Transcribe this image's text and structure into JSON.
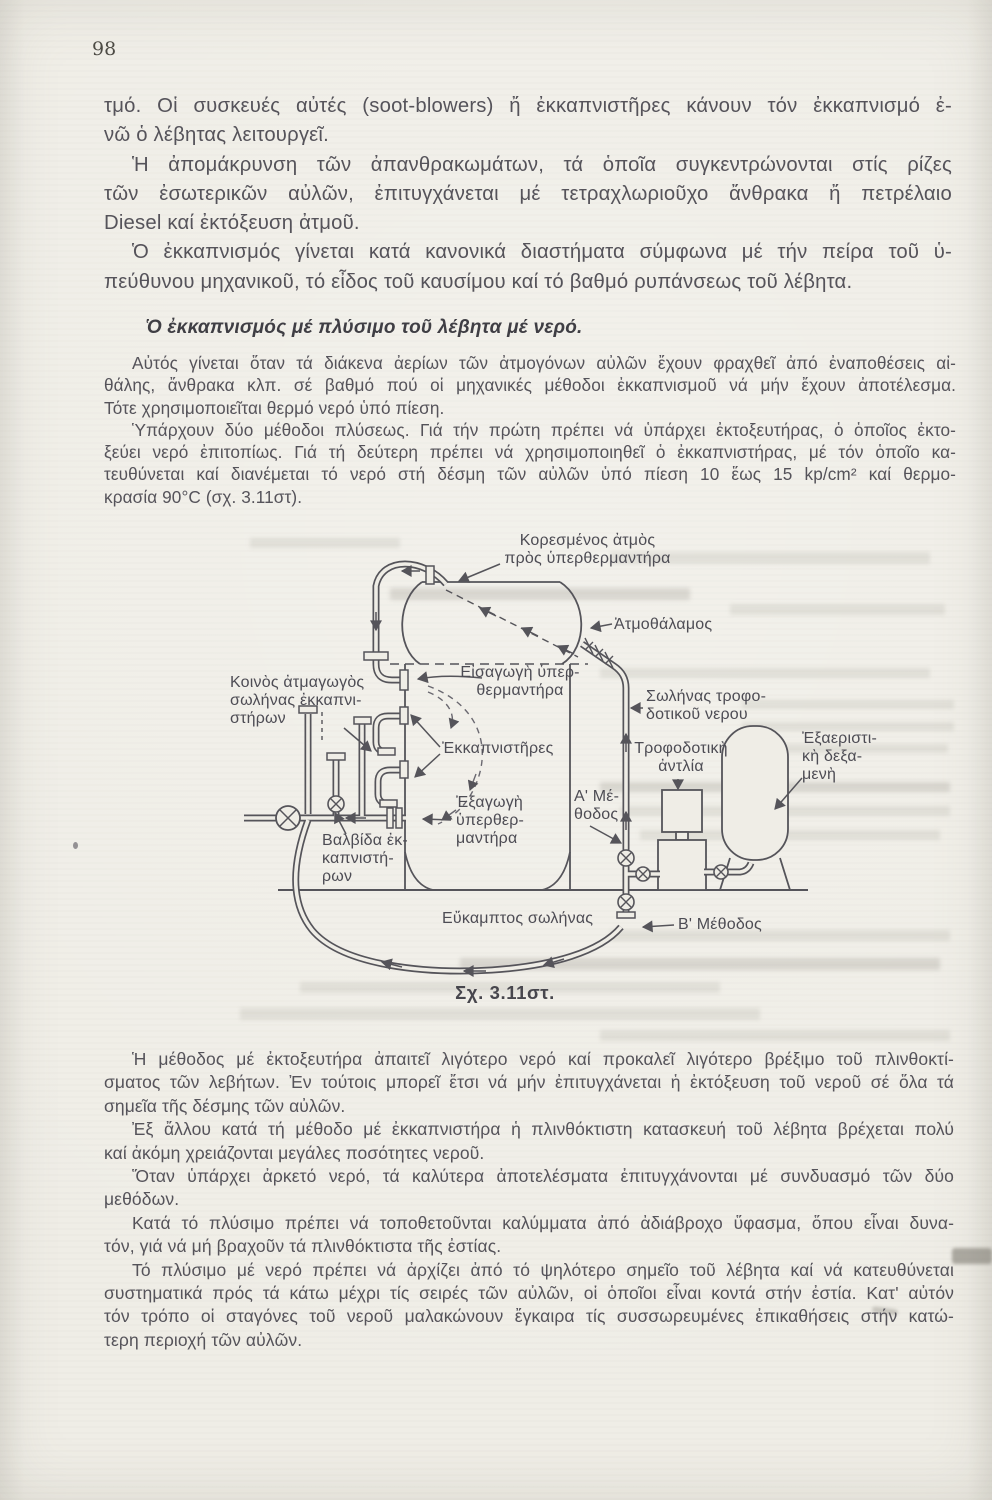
{
  "page": {
    "number": "98",
    "paper_color": "#efede6",
    "ink_color": "#55535a"
  },
  "intro": {
    "paragraphs": [
      {
        "indent": false,
        "lines": [
          "τμό. Οἱ συσκευές αὐτές (soot-blowers) ἤ ἐκκαπνιστῆρες κάνουν τόν ἐκκαπνισμό ἐ-",
          "νῶ ὁ λέβητας λειτουργεῖ."
        ]
      },
      {
        "indent": true,
        "lines": [
          "Ἡ ἀπομάκρυνση τῶν ἀπανθρακωμάτων, τά ὁποῖα συγκεντρώνονται στίς ρίζες",
          "τῶν ἐσωτερικῶν αὐλῶν, ἐπιτυγχάνεται μέ τετραχλωριοῦχο ἄνθρακα ἤ πετρέλαιο",
          "Diesel καί ἐκτόξευση ἀτμοῦ."
        ]
      },
      {
        "indent": true,
        "lines": [
          "Ὁ ἐκκαπνισμός γίνεται κατά κανονικά διαστήματα σύμφωνα μέ τήν πείρα τοῦ ὑ-",
          "πεύθυνου μηχανικοῦ, τό εἶδος τοῦ καυσίμου καί τό βαθμό ρυπάνσεως τοῦ λέβητα."
        ]
      }
    ]
  },
  "heading": {
    "text": "Ὁ ἐκκαπνισμός μέ πλύσιμο τοῦ λέβητα μέ νερό."
  },
  "washing": {
    "paragraphs": [
      {
        "indent": true,
        "lines": [
          "Αὐτός γίνεται ὅταν τά διάκενα ἀερίων τῶν ἀτμογόνων αὐλῶν ἔχουν φραχθεῖ ἀπό ἐναποθέσεις αἰ-",
          "θάλης, ἄνθρακα κλπ. σέ βαθμό πού οἱ μηχανικές μέθοδοι ἐκκαπνισμοῦ νά μήν ἔχουν ἀποτέλεσμα.",
          "Τότε χρησιμοποιεῖται θερμό νερό ὑπό πίεση."
        ]
      },
      {
        "indent": true,
        "lines": [
          "Ὑπάρχουν δύο μέθοδοι πλύσεως. Γιά τήν πρώτη πρέπει νά ὑπάρχει ἐκτοξευτήρας, ὁ ὁποῖος ἐκτο-",
          "ξεύει νερό ἐπιτοπίως. Γιά τή δεύτερη πρέπει νά χρησιμοποιηθεῖ ὁ ἐκκαπνιστήρας, μέ τόν ὁποῖο κα-",
          "τευθύνεται καί διανέμεται τό νερό στή δέσμη τῶν αὐλῶν ὑπό πίεση 10 ἕως 15 kp/cm² καί θερμο-",
          "κρασία 90°C (σχ. 3.11στ)."
        ]
      }
    ]
  },
  "figure": {
    "caption": "Σχ. 3.11στ.",
    "labels": {
      "saturated_steam": "Κορεσμένος ἀτμὸς\nπρὸς ὑπερθερμαντήρα",
      "steam_chamber": "Ἀτμοθάλαμος",
      "superheater_inlet": "Εἰσαγωγὴ ὑπερ-\nθερμαντήρα",
      "common_steam_pipe": "Κοινὸς ἀτμαγωγὸς\nσωλήνας ἐκκαπνι-\nστήρων",
      "soot_blowers": "Ἐκκαπνιστῆρες",
      "superheater_outlet": "Ἐξαγωγὴ\nὑπερθερ-\nμαντήρα",
      "soot_blower_valve": "Βαλβίδα ἐκ-\nκαπνιστή-\nρων",
      "feed_water_pipe": "Σωλήνας τροφο-\nδοτικοῦ νερου",
      "feed_pump": "Τροφοδοτικὴ\nἀντλία",
      "deaerating_tank": "Ἐξαεριστι-\nκὴ δεξα-\nμενὴ",
      "method_a": "Α' Μέ-\nθοδος",
      "method_b": "Β' Μέθοδος",
      "flexible_hose": "Εὔκαμπτος σωλήνας"
    }
  },
  "closing": {
    "paragraphs": [
      {
        "indent": true,
        "lines": [
          "Ἡ μέθοδος μέ ἐκτοξευτήρα ἀπαιτεῖ λιγότερο νερό καί προκαλεῖ λιγότερο βρέξιμο τοῦ πλινθοκτί-",
          "σματος τῶν λεβήτων. Ἐν τούτοις μπορεῖ ἔτσι νά μήν ἐπιτυγχάνεται ἡ ἐκτόξευση τοῦ νεροῦ σέ ὅλα τά",
          "σημεῖα τῆς δέσμης τῶν αὐλῶν."
        ]
      },
      {
        "indent": true,
        "lines": [
          "Ἐξ ἄλλου κατά τή μέθοδο μέ ἐκκαπνιστήρα ἡ πλινθόκτιστη κατασκευή τοῦ λέβητα βρέχεται πολύ",
          "καί ἀκόμη χρειάζονται μεγάλες ποσότητες νεροῦ."
        ]
      },
      {
        "indent": true,
        "lines": [
          "Ὅταν ὑπάρχει ἀρκετό νερό, τά καλύτερα ἀποτελέσματα ἐπιτυγχάνονται μέ συνδυασμό τῶν δύο",
          "μεθόδων."
        ]
      },
      {
        "indent": true,
        "lines": [
          "Κατά τό πλύσιμο πρέπει νά τοποθετοῦνται καλύμματα ἀπό ἀδιάβροχο ὕφασμα, ὅπου εἶναι δυνα-",
          "τόν, γιά νά μή βραχοῦν τά πλινθόκτιστα τῆς ἐστίας."
        ]
      },
      {
        "indent": true,
        "lines": [
          "Τό πλύσιμο μέ νερό πρέπει νά ἀρχίζει ἀπό τό ψηλότερο σημεῖο τοῦ λέβητα καί νά κατευθύνεται",
          "συστηματικά πρός τά κάτω μέχρι τίς σειρές τῶν αὐλῶν, οἱ ὁποῖοι εἶναι κοντά στήν ἐστία. Κατ' αὐτόν",
          "τόν τρόπο οἱ σταγόνες τοῦ νεροῦ μαλακώνουν ἔγκαιρα τίς συσσωρευμένες ἐπικαθήσεις στήν κατώ-",
          "τερη περιοχή τῶν αὐλῶν."
        ]
      }
    ]
  }
}
